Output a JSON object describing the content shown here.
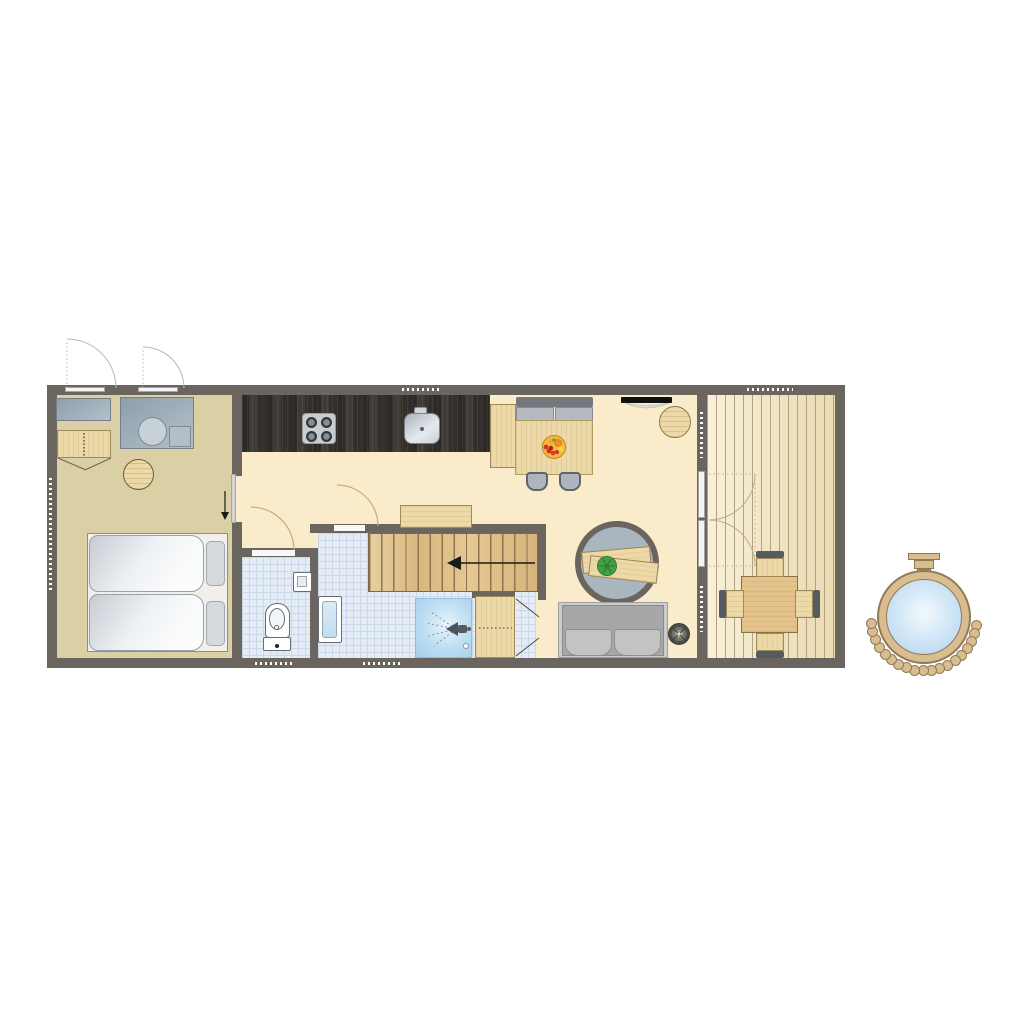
{
  "type": "floor-plan",
  "colors": {
    "wall": "#6b6560",
    "bedroom_floor": "#dbcfa5",
    "hall_floor": "#faeccb",
    "bath_floor": "#e4ecf5",
    "bath_grid": "#ccd8e7",
    "terrace_light": "#f8f0d8",
    "terrace_dark": "#ebdab1",
    "plank_line": "#b1a284",
    "counter_dark": "#35312d",
    "wood_light": "#ecd9a7",
    "wood_border": "#a08a58",
    "stairs_line": "#8d7550",
    "gray_furn_a": "#8ea0ad",
    "gray_furn_b": "#b2bfc8",
    "bench_cushion": "#b4bac1",
    "sofa_gray": "#a7a7a7",
    "sofa_platform": "#cccccc",
    "rug_fill": "#a9b5bf",
    "water_blue": "#bfdcf2",
    "shower_blue": "#aed5ee",
    "tub_wood": "#d9bc90",
    "tub_border": "#8f7a55",
    "plant_green": "#44a045",
    "fruit_orange": "#ef8f22",
    "fruit_red": "#d92f2f",
    "arc_tan": "#c3ad80",
    "arc_gray": "#b8b8b8",
    "arrow_black": "#1a1a1a"
  },
  "rooms": [
    {
      "name": "bedroom",
      "furniture": [
        "double-bed",
        "wardrobe",
        "dresser",
        "vanity-washbasin",
        "pouf",
        "sliding-door",
        "window",
        "window"
      ]
    },
    {
      "name": "kitchen",
      "furniture": [
        "worktop",
        "hob-4-burners",
        "sink",
        "tall-cabinet"
      ]
    },
    {
      "name": "dining-area",
      "furniture": [
        "bench",
        "dining-table",
        "fruit-bowl",
        "chair",
        "chair"
      ]
    },
    {
      "name": "hallway",
      "furniture": [
        "sideboard",
        "staircase-up",
        "toilet-door",
        "bathroom-door"
      ]
    },
    {
      "name": "toilet-room",
      "furniture": [
        "toilet",
        "hand-basin"
      ]
    },
    {
      "name": "bathroom",
      "furniture": [
        "washbasin",
        "shower",
        "closet"
      ]
    },
    {
      "name": "living-area",
      "furniture": [
        "wall-tv",
        "side-table",
        "round-rug",
        "coffee-table",
        "plant",
        "sofa",
        "wood-stove"
      ]
    },
    {
      "name": "terrace",
      "furniture": [
        "french-doors",
        "garden-table",
        "garden-chair",
        "garden-chair",
        "garden-chair",
        "garden-chair"
      ]
    },
    {
      "name": "outdoor",
      "furniture": [
        "wood-fired-hot-tub"
      ]
    }
  ],
  "hot_tub": {
    "stone_count": 19,
    "center_x": 924,
    "center_y": 618,
    "stone_ring_radius": 53,
    "arc_start_deg": 8,
    "arc_end_deg": 174
  }
}
